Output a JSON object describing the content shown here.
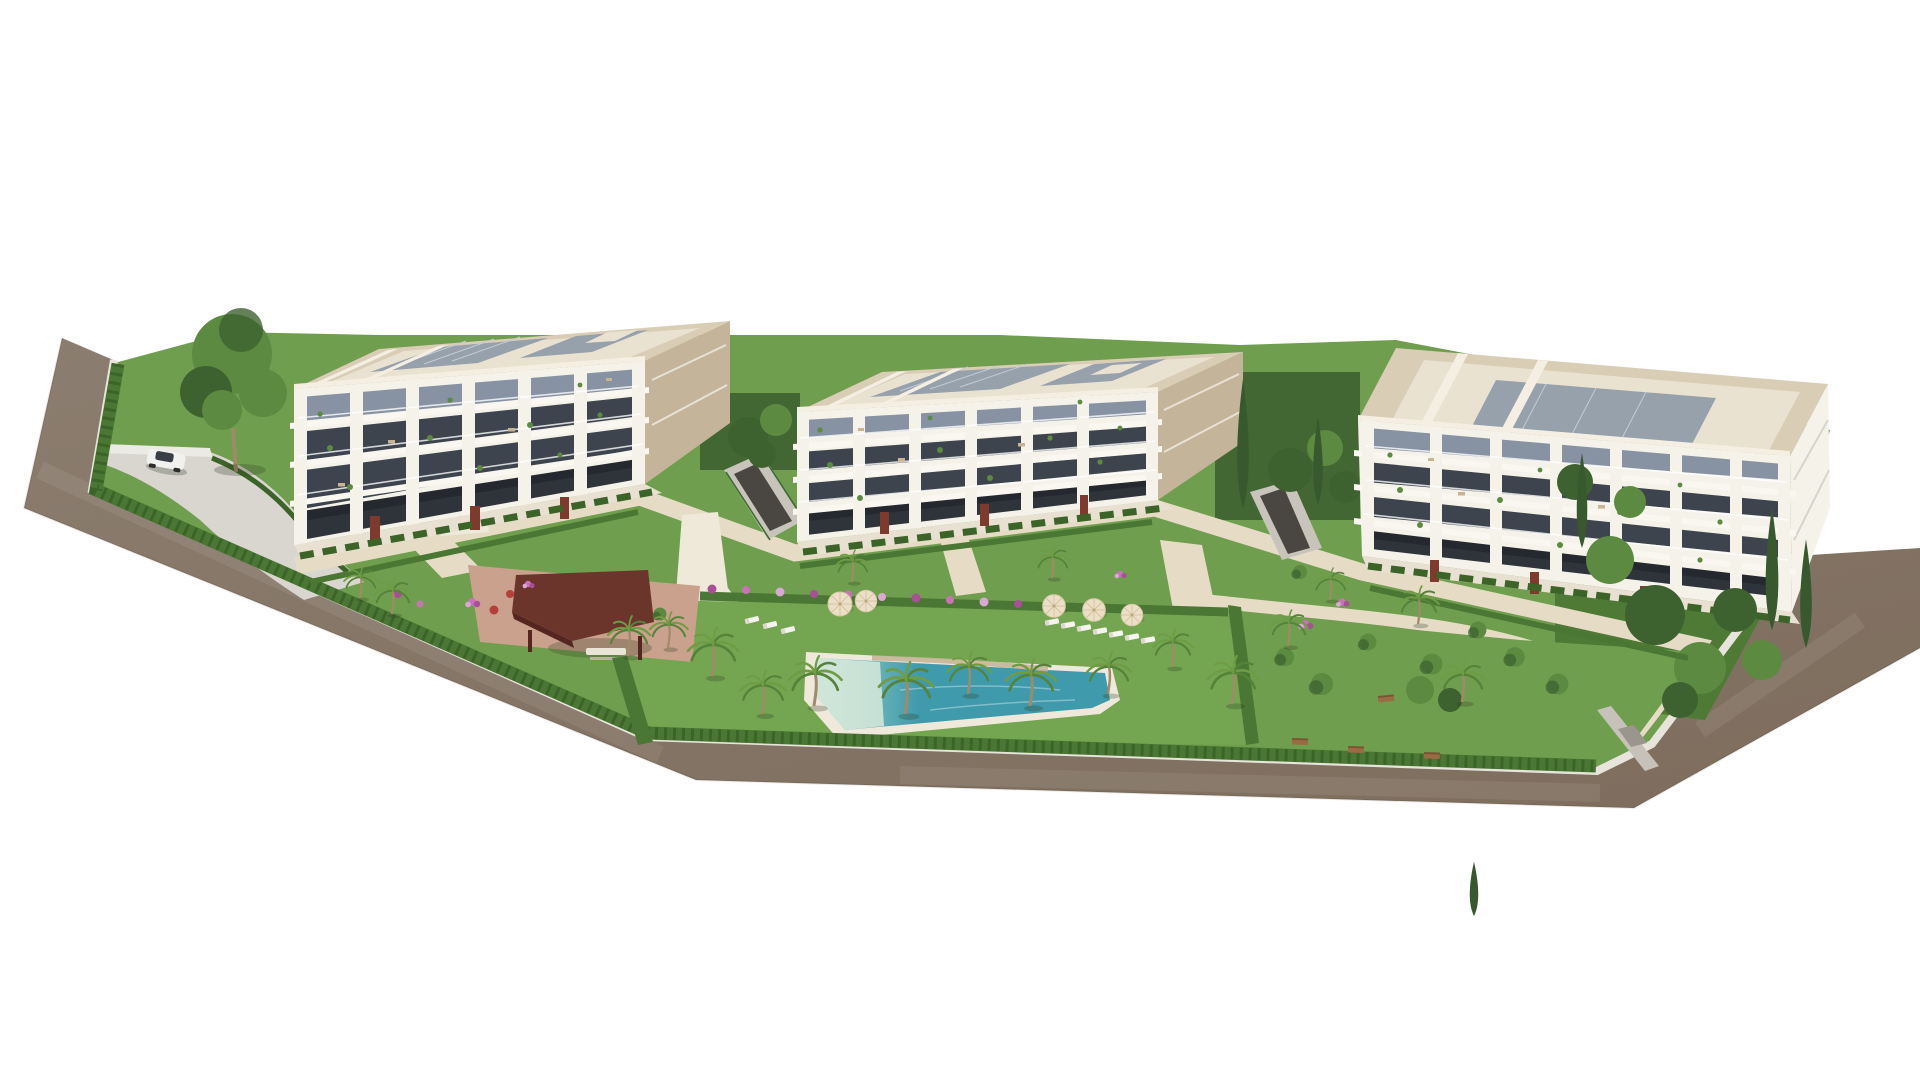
{
  "scene": {
    "type": "architectural-3d-aerial-rendering",
    "description": "Aerial 3D render of a modern residential complex: three cream 4-storey apartment buildings with balconies and flat solar-panel roofs, landscaped gardens with palm trees, a turquoise lagoon pool with beach entry, sun loungers and umbrellas, a dark-red timber pergola, perimeter hedge and a taupe road wrapping the site on a white background",
    "background": "#ffffff"
  },
  "site": {
    "boundary": "irregular polygon wrapped by road on left, bottom and right",
    "perimeter": "clipped green hedge with light curb/sidewalk",
    "entrance_wall": "small white gate structure near pergola",
    "rear_gate": "gray wall with door at bottom-right boundary"
  },
  "buildings": [
    {
      "name": "building-left",
      "floors": 4,
      "facade": "white grid of piers and slabs over dark glazing",
      "roof": "flat, cream parapet, gray solar panels",
      "ground_floor": "terraces with corten dividers and hedges"
    },
    {
      "name": "building-middle",
      "floors": 4,
      "facade": "white grid of piers and slabs over dark glazing",
      "roof": "flat, cream parapet, gray solar panels",
      "ground_floor": "terraces with corten dividers and hedges"
    },
    {
      "name": "building-right",
      "floors": 4,
      "facade": "white grid of piers and slabs over dark glazing, rotated orientation",
      "roof": "flat, cream parapet, gray solar panels",
      "ground_floor": "terraces with corten dividers and hedges"
    }
  ],
  "amenities": {
    "pool": {
      "shape": "elongated lagoon with beach entry",
      "water": "turquoise"
    },
    "pergola": {
      "roof": "dark red-brown timber",
      "furniture": "picnic table"
    },
    "umbrellas_count": 5,
    "sun_loungers_count": 10,
    "benches_count": 4,
    "palm_trees_count": 19,
    "car": {
      "type": "white SUV",
      "location": "driveway at top-left"
    },
    "garage_ramp": "between left and middle buildings",
    "garden": "lawns, round shrubs, pink and red flower beds, cypress trees"
  },
  "colors": {
    "bg": "#ffffff",
    "road": "#8b7d6f",
    "roadDark": "#7e6d5d",
    "curb": "#e7e4dc",
    "lawn": "#6f9e4e",
    "lawnLight": "#74a651",
    "lawnDark": "#4f7a35",
    "hedge": "#4a7733",
    "hedgeDark": "#3c6429",
    "path": "#e6dcc6",
    "deck": "#efe9da",
    "drive": "#d9d6d0",
    "pergDeck": "#c9a18c",
    "facade": "#f5f2ea",
    "wallBeige": "#d7c9ad",
    "beigeShade": "#c4b59a",
    "glass": "#3d444e",
    "glassLight": "#8793a3",
    "glassDim": "#2f343b",
    "slab": "#faf7f1",
    "railing": "rgba(255,255,255,0.78)",
    "roofBase": "#d9cdb5",
    "roofDeck": "#eae2d0",
    "roofEdge": "#f4efe2",
    "panel": "#96a1ac",
    "panelLine": "#c3ccd4",
    "corten": "#7e3a2c",
    "terrace": "#e8e1d2",
    "pergola": "#6b352c",
    "pergolaDark": "#54261f",
    "wood": "#7c4a33",
    "palmLeaf": "#6f9c44",
    "palmLeafDark": "#55833a",
    "palmTrunk": "#a08a68",
    "treeGreen": "#5c8a41",
    "treeDark": "#3e6130",
    "cypress": "#38582e",
    "flowerPink": "#c873b8",
    "flowerMagenta": "#a84f98",
    "flowerRed": "#b5403a",
    "flowerLilac": "#d9a9d4",
    "water": "#3f9aab",
    "waterShallow": "#9fd4cd",
    "beachEntry": "#d8e9da",
    "coping": "#efe9dc",
    "rock": "#c6b597",
    "umbrella": "#ecdfc8",
    "lounger": "#f6f4ee",
    "benchWood": "#9a6b44",
    "carBody": "#f1f1ef",
    "carGlass": "#3a3f46",
    "wallGray": "#c6c2ba",
    "gateGray": "#9a968e",
    "rampDark": "#4a4742",
    "rampWall": "#c9c4bb",
    "fence": "#3e6b34",
    "shadow": "rgba(50,60,35,0.28)",
    "furniture": "#c8b393"
  }
}
